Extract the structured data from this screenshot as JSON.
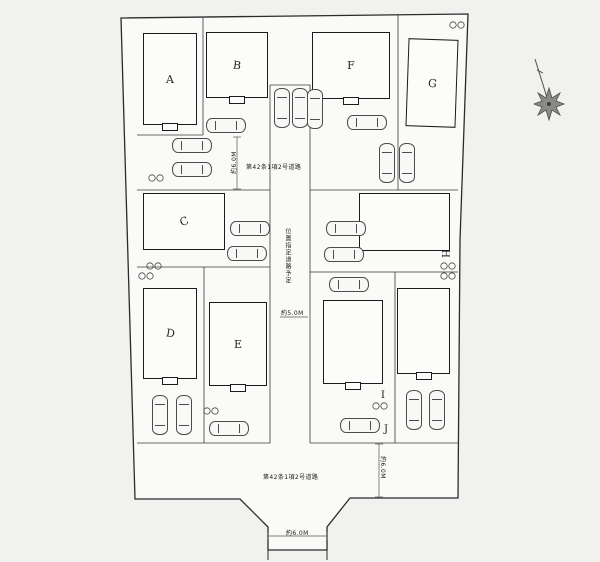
{
  "buildings": [
    {
      "label": "A"
    },
    {
      "label": "B"
    },
    {
      "label": "C"
    },
    {
      "label": "D"
    },
    {
      "label": "E"
    },
    {
      "label": "F"
    },
    {
      "label": "G"
    },
    {
      "label": "H"
    },
    {
      "label": "I"
    },
    {
      "label": "J"
    }
  ],
  "roads": {
    "top_road_label": "第42条1項2号道路",
    "center_road_label": "位置指定道路予定",
    "bottom_road_label": "第42条1項2号道路"
  },
  "dimensions": {
    "left_vertical": "約6.0M",
    "center": "約5.0M",
    "right_vertical": "約6.0M",
    "bottom": "約6.0M"
  },
  "icons": {
    "compass": "compass-rose-icon",
    "car": "parked-car-icon",
    "parking_marker": "circled-number-pair"
  },
  "colors": {
    "line": "#2b2b2b",
    "paper": "#f1f1ef",
    "texture": "#9b9b98"
  }
}
